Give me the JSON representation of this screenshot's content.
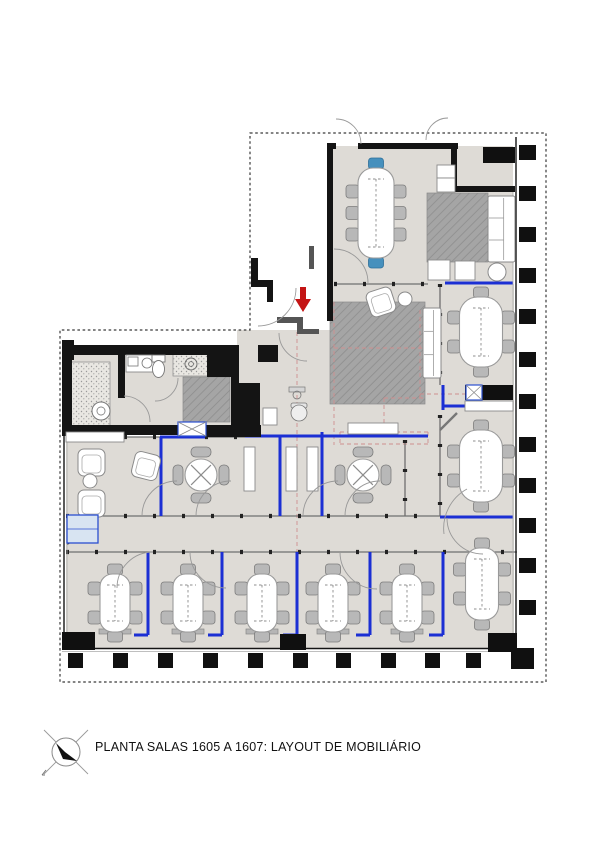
{
  "title_block": {
    "label": "PLANTA SALAS 1605 A 1607: LAYOUT DE MOBILIÁRIO",
    "icon": "north-arrow-icon"
  },
  "palette": {
    "floor": "#dedbd6",
    "rug_base": "#a5a5a5",
    "rug_line": "#8d8d8d",
    "stipple_bg": "#e9e7e2",
    "stipple_dot": "#9a9a9a",
    "wall": "#141414",
    "wall_gray": "#555555",
    "glass": "#6f6f6f",
    "mullion": "#222222",
    "blue": "#1b2fd4",
    "light_blue_fill": "#d8e4f2",
    "light_blue_stroke": "#2b4fd0",
    "red": "#c41414",
    "red_dash": "#cf8f8f",
    "chair_fill": "#b8b8b8",
    "chair_stroke": "#7c7c7c",
    "chair_blue": "#4690bd",
    "chair_blue_stroke": "#2d6f99",
    "table_fill": "#ffffff",
    "table_stroke": "#9a9a9a",
    "boundary": "#3a3a3a",
    "column": "#101010",
    "lightline": "#aaaaaa",
    "white_box_stroke": "#8a8a8a",
    "arc": "#999999",
    "console": "#b5b5b5"
  },
  "plan": {
    "boundary_path": "M250,133 H546 V682 H60 V330 H250 Z",
    "floors": [
      [
        333,
        146,
        180,
        138
      ],
      [
        440,
        284,
        74,
        364
      ],
      [
        333,
        284,
        107,
        48
      ],
      [
        237,
        330,
        203,
        108
      ],
      [
        66,
        437,
        374,
        212
      ],
      [
        124,
        353,
        110,
        73
      ],
      [
        66,
        353,
        58,
        73
      ],
      [
        148,
        375,
        36,
        51
      ]
    ],
    "pattern_areas": [
      [
        427,
        193,
        61,
        69,
        "rugpat"
      ],
      [
        330,
        302,
        95,
        102,
        "rugpat"
      ],
      [
        183,
        377,
        47,
        45,
        "rugpat"
      ],
      [
        173,
        354,
        35,
        22,
        "stipplepat"
      ],
      [
        68,
        362,
        42,
        64,
        "stipplepat"
      ]
    ],
    "red_dashes": [
      [
        297,
        332,
        297,
        560
      ],
      [
        334,
        302,
        334,
        445
      ],
      [
        334,
        348,
        425,
        348
      ],
      [
        340,
        432,
        428,
        432
      ],
      [
        340,
        444,
        428,
        444
      ],
      [
        340,
        432,
        340,
        444
      ],
      [
        428,
        432,
        428,
        444
      ],
      [
        420,
        310,
        420,
        400
      ],
      [
        420,
        394,
        470,
        394
      ],
      [
        384,
        398,
        384,
        430
      ],
      [
        384,
        398,
        425,
        398
      ]
    ],
    "glass_walls": [
      [
        334,
        284,
        428,
        284
      ],
      [
        66,
        437,
        160,
        437
      ],
      [
        205,
        437,
        245,
        437
      ],
      [
        66,
        516,
        440,
        516
      ],
      [
        66,
        552,
        517,
        552
      ],
      [
        440,
        415,
        440,
        516
      ],
      [
        440,
        284,
        440,
        385
      ],
      [
        405,
        440,
        405,
        516
      ]
    ],
    "blue_lines": [
      [
        160,
        437,
        205,
        437
      ],
      [
        245,
        436,
        428,
        436
      ],
      [
        161,
        437,
        161,
        516
      ],
      [
        280,
        437,
        280,
        516
      ],
      [
        322,
        432,
        322,
        516
      ],
      [
        445,
        283,
        513,
        283
      ],
      [
        440,
        517,
        513,
        517
      ],
      [
        443,
        385,
        443,
        410
      ],
      [
        443,
        406,
        470,
        406
      ],
      [
        148,
        552,
        148,
        635
      ],
      [
        134,
        635,
        148,
        635
      ],
      [
        222,
        552,
        222,
        635
      ],
      [
        208,
        635,
        222,
        635
      ],
      [
        297,
        552,
        297,
        635
      ],
      [
        283,
        635,
        297,
        635
      ],
      [
        370,
        552,
        370,
        635
      ],
      [
        356,
        635,
        370,
        635
      ],
      [
        443,
        552,
        443,
        635
      ],
      [
        429,
        635,
        443,
        635
      ]
    ],
    "thin_lines": [
      [
        516,
        137,
        516,
        650,
        1.4,
        "wall"
      ],
      [
        513,
        192,
        513,
        648,
        0.8,
        "lightline"
      ],
      [
        62,
        648.5,
        517,
        648.5,
        1.4,
        "wall"
      ],
      [
        62,
        651.5,
        513,
        651.5,
        0.8,
        "lightline"
      ],
      [
        64,
        435,
        64,
        649,
        1.4,
        "wall"
      ],
      [
        67,
        437,
        67,
        648,
        0.8,
        "lightline"
      ]
    ],
    "walls_gray": [
      [
        277,
        317,
        26,
        6
      ],
      [
        297,
        321,
        6,
        13
      ],
      [
        302,
        329,
        17,
        5
      ],
      [
        309,
        246,
        5,
        23
      ]
    ],
    "walls_black": [
      [
        327,
        143,
        9,
        6
      ],
      [
        358,
        143,
        100,
        6
      ],
      [
        451,
        143,
        6,
        45
      ],
      [
        451,
        186,
        64,
        6
      ],
      [
        327,
        143,
        6,
        178
      ],
      [
        251,
        258,
        7,
        29
      ],
      [
        251,
        280,
        22,
        7
      ],
      [
        267,
        285,
        6,
        17
      ],
      [
        258,
        345,
        20,
        17
      ],
      [
        62,
        340,
        12,
        20
      ],
      [
        62,
        345,
        173,
        10
      ],
      [
        118,
        353,
        7,
        45
      ],
      [
        207,
        350,
        27,
        27
      ],
      [
        231,
        345,
        8,
        42
      ],
      [
        231,
        383,
        29,
        54
      ],
      [
        62,
        352,
        10,
        84
      ],
      [
        62,
        425,
        117,
        10
      ],
      [
        205,
        425,
        56,
        12
      ]
    ],
    "columns_right": {
      "x": 519,
      "w": 17,
      "h": 15,
      "ys": [
        145,
        186,
        227,
        268,
        309,
        352,
        394,
        437,
        478,
        518,
        558,
        600
      ]
    },
    "columns_bottom": {
      "y": 653,
      "w": 15,
      "h": 15,
      "xs": [
        68,
        113,
        158,
        203,
        248,
        293,
        336,
        381,
        425,
        466
      ]
    },
    "corner_column": [
      511,
      648,
      23,
      21
    ],
    "black_boxes": [
      [
        483,
        147,
        32,
        16
      ],
      [
        465,
        385,
        48,
        15
      ],
      [
        62,
        632,
        33,
        18
      ],
      [
        280,
        634,
        26,
        16
      ],
      [
        488,
        633,
        29,
        19
      ]
    ],
    "white_boxes": [
      [
        437,
        165,
        18,
        13
      ],
      [
        437,
        178,
        18,
        14
      ],
      [
        465,
        401,
        48,
        10
      ],
      [
        66,
        432,
        58,
        10
      ],
      [
        244,
        447,
        11,
        44
      ],
      [
        286,
        447,
        11,
        44
      ],
      [
        307,
        447,
        11,
        44
      ],
      [
        348,
        423,
        50,
        11
      ],
      [
        428,
        260,
        22,
        20
      ],
      [
        455,
        261,
        20,
        19
      ],
      [
        263,
        408,
        14,
        17
      ],
      [
        126,
        355,
        28,
        17
      ]
    ],
    "x_boxes": [
      [
        466,
        385,
        16,
        15
      ],
      [
        178,
        422,
        28,
        14
      ]
    ],
    "oval_tables": [
      {
        "cx": 376,
        "cy": 213,
        "w": 36,
        "h": 90,
        "rows": 3,
        "headBlue": true
      },
      {
        "cx": 481,
        "cy": 332,
        "w": 43,
        "h": 70,
        "rows": 2,
        "headBlue": false
      },
      {
        "cx": 481,
        "cy": 466,
        "w": 43,
        "h": 72,
        "rows": 2,
        "headBlue": false
      },
      {
        "cx": 115,
        "cy": 603,
        "w": 30,
        "h": 58,
        "rows": 2,
        "headBlue": false
      },
      {
        "cx": 188,
        "cy": 603,
        "w": 30,
        "h": 58,
        "rows": 2,
        "headBlue": false
      },
      {
        "cx": 262,
        "cy": 603,
        "w": 30,
        "h": 58,
        "rows": 2,
        "headBlue": false
      },
      {
        "cx": 333,
        "cy": 603,
        "w": 30,
        "h": 58,
        "rows": 2,
        "headBlue": false
      },
      {
        "cx": 407,
        "cy": 603,
        "w": 30,
        "h": 58,
        "rows": 2,
        "headBlue": false
      },
      {
        "cx": 482,
        "cy": 584,
        "w": 33,
        "h": 72,
        "rows": 2,
        "headBlue": false
      }
    ],
    "round_tables": [
      {
        "cx": 201,
        "cy": 475,
        "r": 16
      },
      {
        "cx": 363,
        "cy": 475,
        "r": 16
      }
    ],
    "consoles": [
      [
        99,
        629,
        32,
        5
      ],
      [
        172,
        629,
        32,
        5
      ],
      [
        246,
        629,
        32,
        5
      ],
      [
        317,
        629,
        32,
        5
      ],
      [
        391,
        629,
        32,
        5
      ]
    ],
    "arcs": [
      "M336,119 A25,25 0 0 1 361,144",
      "M426,140 A22,22 0 0 1 448,118",
      "M334,249 A34,34 0 0 1 368,283",
      "M296,288 A38,38 0 0 1 258,326",
      "M279,333 A28,28 0 0 0 307,361",
      "M124,396 A26,26 0 0 1 150,422",
      "M178,378 A23,23 0 0 1 155,401",
      "M177,481 A35,35 0 0 0 142,516",
      "M196,516 A35,35 0 0 1 231,481",
      "M338,481 A35,35 0 0 0 303,516",
      "M345,516 A35,35 0 0 1 380,481",
      "M467,489 A45,45 0 0 0 444,534",
      "M117,588 A36,36 0 0 1 153,552",
      "M190,552 A36,36 0 0 0 226,588",
      "M340,552 A37,37 0 0 0 377,589",
      "M447,518 A36,36 0 0 0 483,554"
    ],
    "misc": [
      {
        "t": "sofa",
        "x": 488,
        "y": 196,
        "w": 27,
        "h": 66
      },
      {
        "t": "sofa",
        "x": 423,
        "y": 308,
        "w": 18,
        "h": 70
      },
      {
        "t": "armchair",
        "x": 78,
        "y": 449,
        "s": 27,
        "rot": 0
      },
      {
        "t": "armchair",
        "x": 78,
        "y": 490,
        "s": 27,
        "rot": 0
      },
      {
        "t": "armchair",
        "x": 133,
        "y": 453,
        "s": 26,
        "rot": 14
      },
      {
        "t": "armchair",
        "x": 368,
        "y": 289,
        "s": 26,
        "rot": -18
      },
      {
        "t": "circle",
        "cx": 405,
        "cy": 299,
        "r": 7
      },
      {
        "t": "circle",
        "cx": 90,
        "cy": 481,
        "r": 7
      },
      {
        "t": "circle",
        "cx": 497,
        "cy": 272,
        "r": 9
      },
      {
        "t": "washer",
        "cx": 101,
        "cy": 411,
        "r": 9
      },
      {
        "t": "drain",
        "cx": 191,
        "cy": 364,
        "r": 6
      },
      {
        "t": "toilet",
        "x": 152,
        "y": 355
      },
      {
        "t": "sinkdetail",
        "x": 128,
        "y": 357
      },
      {
        "t": "officechair",
        "cx": 299,
        "cy": 412
      },
      {
        "t": "deskitem",
        "x": 289,
        "y": 387
      },
      {
        "t": "leaf",
        "x1": 440,
        "y1": 430,
        "x2": 457,
        "y2": 413
      },
      {
        "t": "tridoor",
        "pts": "68,518 89,531 68,544"
      },
      {
        "t": "bluecab",
        "x": 67,
        "y": 515,
        "w": 31,
        "h": 28
      },
      {
        "t": "arrow",
        "x": 300,
        "y": 287
      }
    ]
  }
}
